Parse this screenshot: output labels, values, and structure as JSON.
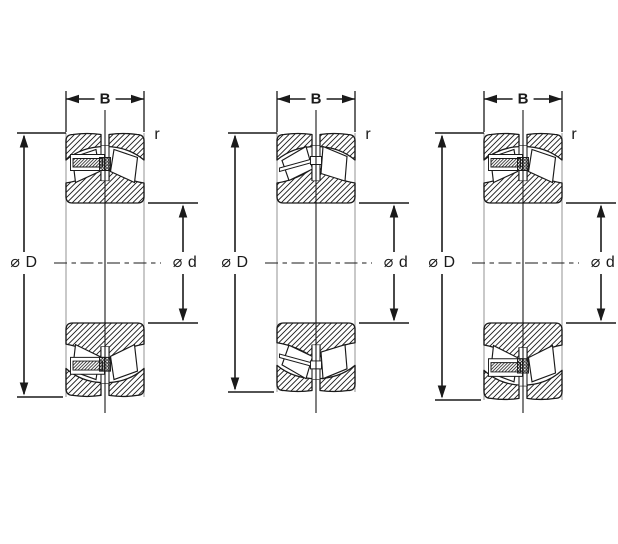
{
  "figure": {
    "kind": "spherical-roller-bearing-cross-sections",
    "colors": {
      "line": "#1a1a1a",
      "face_line": "#b2b2b2",
      "background": "#ffffff"
    },
    "bearings": [
      {
        "name": "left-bearing",
        "style": "with-centre-guide-ring",
        "labels": {
          "width": "B",
          "corner_radius": "r",
          "outer_diameter": "⌀ D",
          "bore_diameter": "⌀ d"
        }
      },
      {
        "name": "middle-bearing",
        "style": "without-centre-guide-ring",
        "labels": {
          "width": "B",
          "corner_radius": "r",
          "outer_diameter": "⌀ D",
          "bore_diameter": "⌀ d"
        }
      },
      {
        "name": "right-bearing",
        "style": "with-centre-guide-ring",
        "labels": {
          "width": "B",
          "corner_radius": "r",
          "outer_diameter": "⌀ D",
          "bore_diameter": "⌀ d"
        }
      }
    ]
  }
}
